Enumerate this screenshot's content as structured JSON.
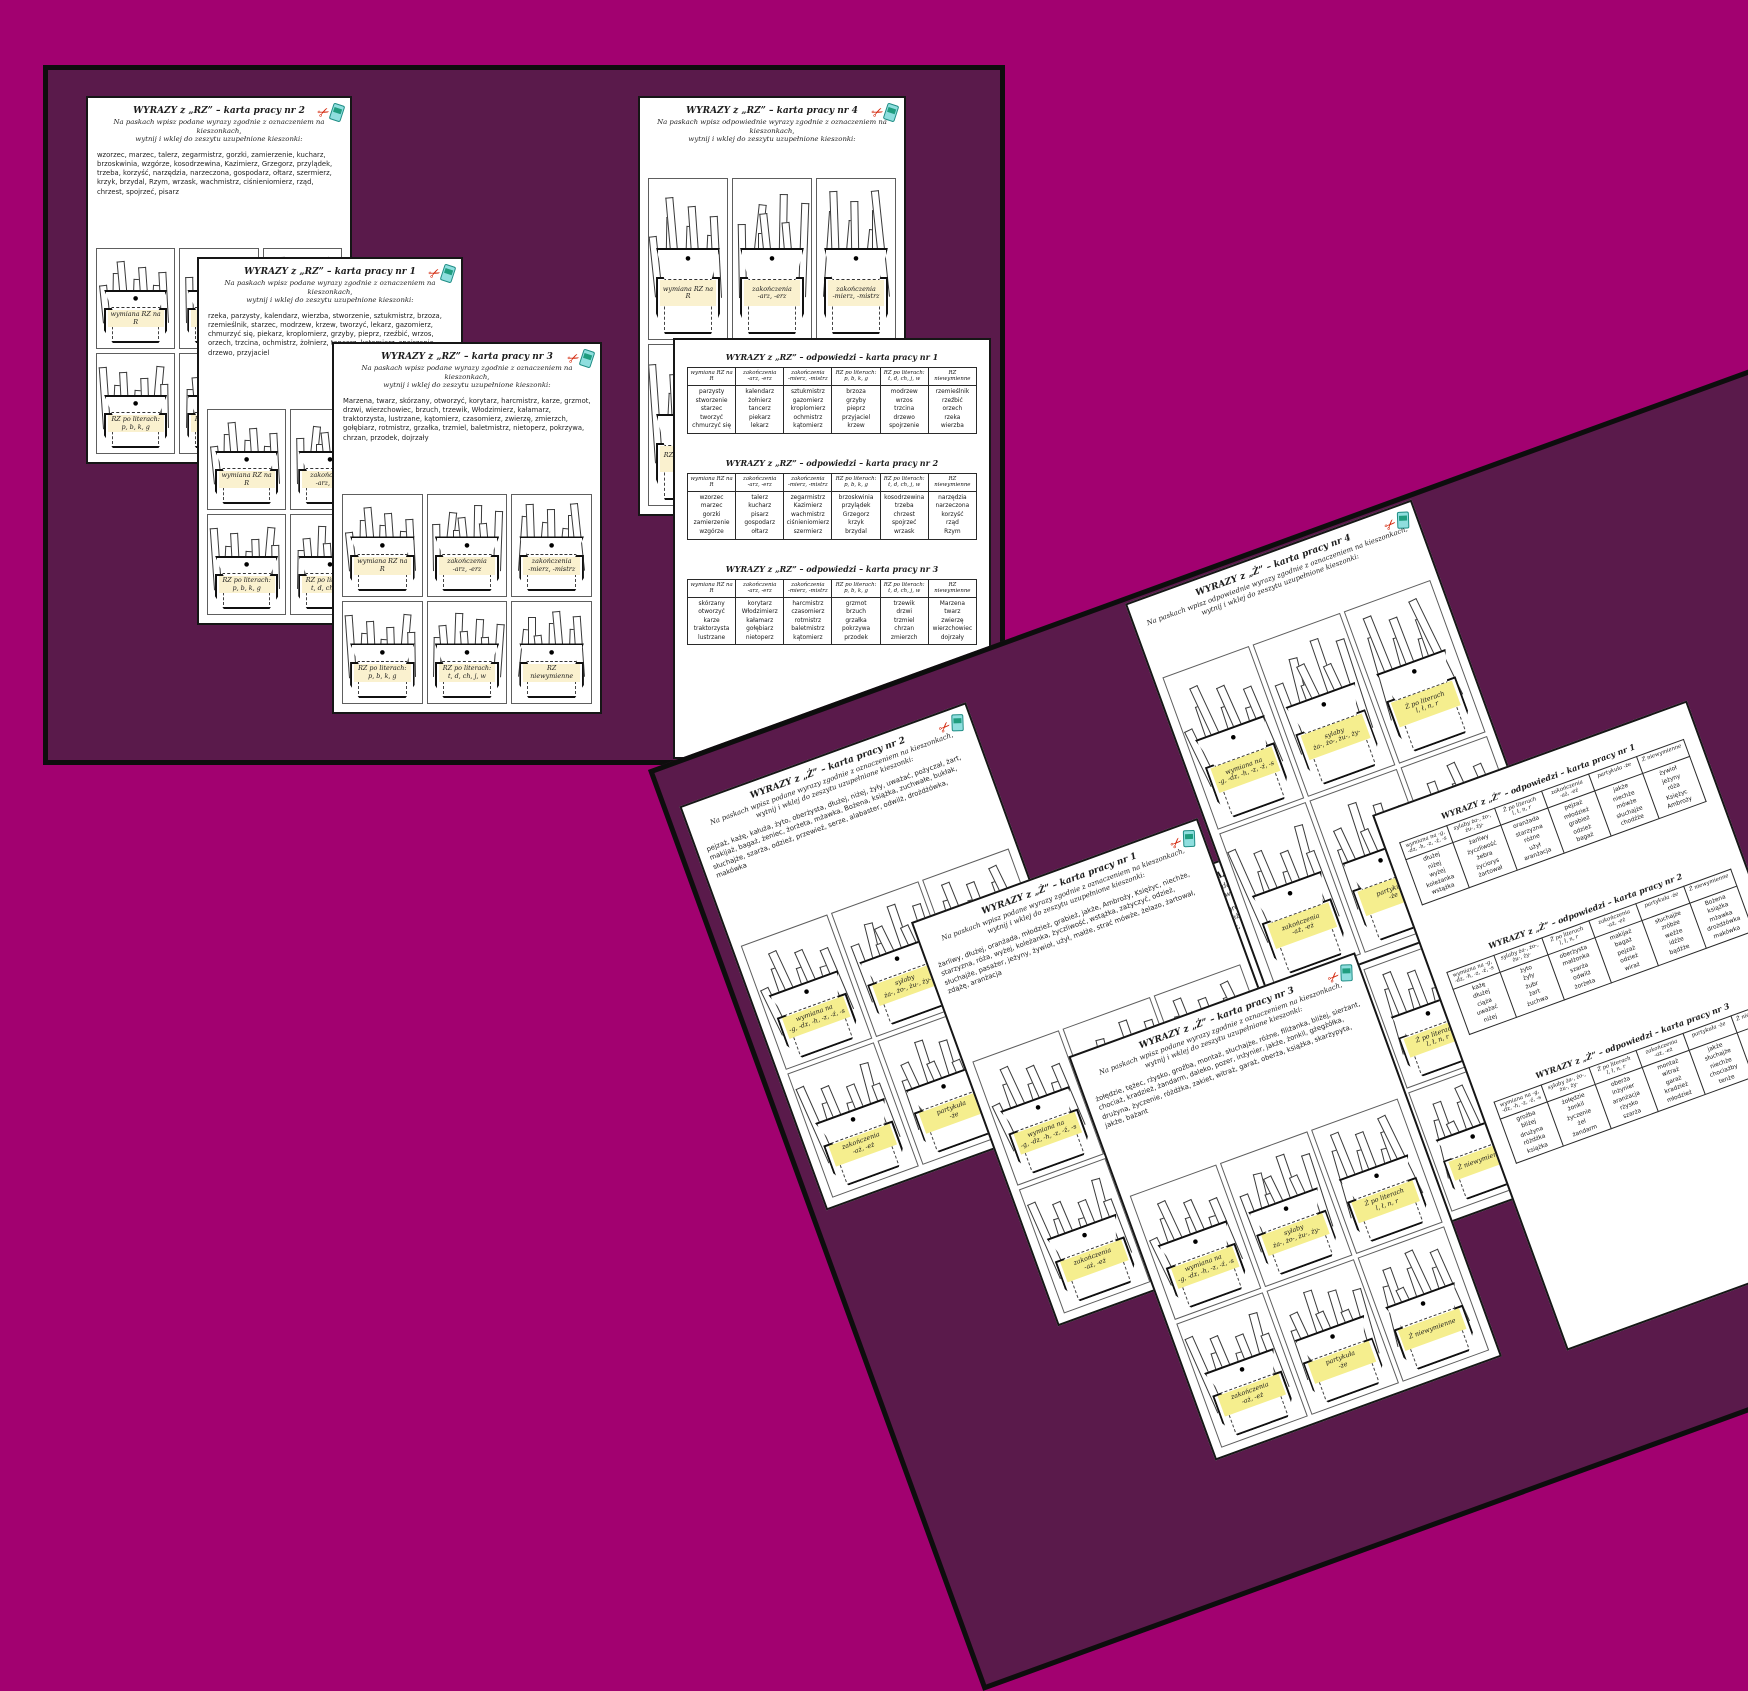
{
  "colors": {
    "page_bg": "#a20170",
    "board_bg": "#5a1a4b",
    "label_cream": "#faf1cf",
    "label_yellow": "#f5ee8e",
    "scissors_red": "#d42a0f",
    "glue_teal": "#8fdede"
  },
  "icons": {
    "scissors": "scissors-icon",
    "glue": "glue-bottle-icon"
  },
  "rz_pockets": [
    "wymiana RZ na R",
    "zakończenia\n-arz, -erz",
    "zakończenia\n-mierz, -mistrz",
    "RZ po literach:\np, b, k, g",
    "RZ po literach:\nt, d, ch, j, w",
    "RZ niewymienne"
  ],
  "z_pockets": [
    "wymiana na\n-g, -dz, -h, -z, -ź, -s",
    "sylaby\nża-, żo-, żu-, ży-",
    "Ż po literach\nl, ł, n, r",
    "zakończenia\n-aż, -eż",
    "partykuła\n-że",
    "Ż niewymienne"
  ],
  "boards": {
    "straight": {
      "sheets": {
        "rz2": {
          "title": "WYRAZY z „RZ” – karta pracy nr 2",
          "instructions": "Na paskach wpisz podane wyrazy zgodnie z oznaczeniem na kieszonkach,\nwytnij i wklej do zeszytu uzupełnione kieszonki:",
          "words": "wzorzec, marzec, talerz, zegarmistrz, gorzki, zamierzenie, kucharz, brzoskwinia, wzgórze, kosodrzewina, Kazimierz, Grzegorz, przylądek, trzeba, korzyść, narzędzia, narzeczona, gospodarz, ołtarz, szermierz, krzyk, brzydal, Rzym, wrzask, wachmistrz, ciśnieniomierz, rząd, chrzest, spojrzeć, pisarz",
          "pockets": [
            "wymiana RZ na R",
            "zakończenia\n-arz, -erz",
            "zakończenia\n-mierz, -mistrz",
            "RZ po literach:\np, b, k, g",
            "RZ po literach:\nt, d, ch, j, w",
            "RZ niewymienne"
          ]
        },
        "rz1": {
          "title": "WYRAZY z „RZ” – karta pracy nr 1",
          "instructions": "Na paskach wpisz podane wyrazy zgodnie z oznaczeniem na kieszonkach,\nwytnij i wklej do zeszytu uzupełnione kieszonki:",
          "words": "rzeka, parzysty, kalendarz, wierzba, stworzenie, sztukmistrz, brzoza, rzemieślnik, starzec, modrzew, krzew, tworzyć, lekarz, gazomierz, chmurzyć się, piekarz, kroplomierz, grzyby, pieprz, rzeźbić, wrzos, orzech, trzcina, ochmistrz, żołnierz, tancerz, kątomierz, spojrzenie, drzewo, przyjaciel",
          "pockets": [
            "wymiana RZ na R",
            "zakończenia\n-arz, -erz",
            "zakończenia\n-mierz, -mistrz",
            "RZ po literach:\np, b, k, g",
            "RZ po literach:\nt, d, ch, j, w",
            "RZ niewymienne"
          ]
        },
        "rz3": {
          "title": "WYRAZY z „RZ” – karta pracy nr 3",
          "instructions": "Na paskach wpisz podane wyrazy zgodnie z oznaczeniem na kieszonkach,\nwytnij i wklej do zeszytu uzupełnione kieszonki:",
          "words": "Marzena, twarz, skórzany, otworzyć, korytarz, harcmistrz, karze, grzmot, drzwi, wierzchowiec, brzuch, trzewik, Włodzimierz, kałamarz, traktorzysta, lustrzane, kątomierz, czasomierz, zwierzę, zmierzch, gołębiarz, rotmistrz, grzałka, trzmiel, baletmistrz, nietoperz, pokrzywa, chrzan, przodek, dojrzały",
          "pockets": [
            "wymiana RZ na R",
            "zakończenia\n-arz, -erz",
            "zakończenia\n-mierz, -mistrz",
            "RZ po literach:\np, b, k, g",
            "RZ po literach:\nt, d, ch, j, w",
            "RZ niewymienne"
          ]
        },
        "rz4": {
          "title": "WYRAZY z „RZ” – karta pracy nr 4",
          "instructions": "Na paskach wpisz odpowiednie wyrazy zgodnie z oznaczeniem na kieszonkach,\nwytnij i wklej do zeszytu uzupełnione kieszonki:",
          "words": "",
          "pockets": [
            "wymiana RZ na R",
            "zakończenia\n-arz, -erz",
            "zakończenia\n-mierz, -mistrz",
            "RZ po literach:\np, b, k, g",
            "RZ po literach:\nt, d, ch, j, w",
            "RZ niewymienne"
          ]
        },
        "rz_answers": {
          "tables": [
            {
              "title": "WYRAZY z „RZ”  – odpowiedzi – karta pracy nr 1",
              "headers": [
                "wymiana RZ na R",
                "zakończenia\n-arz, -erz",
                "zakończenia\n-mierz, -mistrz",
                "RZ po literach:\np, b, k, g",
                "RZ po literach:\nt, d, ch, j, w",
                "RZ niewymienne"
              ],
              "columns": [
                [
                  "parzysty",
                  "stworzenie",
                  "starzec",
                  "tworzyć",
                  "chmurzyć się"
                ],
                [
                  "kalendarz",
                  "żołnierz",
                  "tancerz",
                  "piekarz",
                  "lekarz"
                ],
                [
                  "sztukmistrz",
                  "gazomierz",
                  "kroplomierz",
                  "ochmistrz",
                  "kątomierz"
                ],
                [
                  "brzoza",
                  "grzyby",
                  "pieprz",
                  "przyjaciel",
                  "krzew"
                ],
                [
                  "modrzew",
                  "wrzos",
                  "trzcina",
                  "drzewo",
                  "spojrzenie"
                ],
                [
                  "rzemieślnik",
                  "rzeźbić",
                  "orzech",
                  "rzeka",
                  "wierzba"
                ]
              ]
            },
            {
              "title": "WYRAZY z „RZ”  – odpowiedzi – karta pracy nr 2",
              "headers": [
                "wymiana RZ na R",
                "zakończenia\n-arz, -erz",
                "zakończenia\n-mierz, -mistrz",
                "RZ po literach:\np, b, k, g",
                "RZ po literach:\nt, d, ch, j, w",
                "RZ niewymienne"
              ],
              "columns": [
                [
                  "wzorzec",
                  "marzec",
                  "gorzki",
                  "zamierzenie",
                  "wzgórze"
                ],
                [
                  "talerz",
                  "kucharz",
                  "pisarz",
                  "gospodarz",
                  "ołtarz"
                ],
                [
                  "zegarmistrz",
                  "Kazimierz",
                  "wachmistrz",
                  "ciśnieniomierz",
                  "szermierz"
                ],
                [
                  "brzoskwinia",
                  "przylądek",
                  "Grzegorz",
                  "krzyk",
                  "brzydal"
                ],
                [
                  "kosodrzewina",
                  "trzeba",
                  "chrzest",
                  "spojrzeć",
                  "wrzask"
                ],
                [
                  "narzędzia",
                  "narzeczona",
                  "korzyść",
                  "rząd",
                  "Rzym"
                ]
              ]
            },
            {
              "title": "WYRAZY z „RZ”  – odpowiedzi – karta pracy nr 3",
              "headers": [
                "wymiana RZ na R",
                "zakończenia\n-arz, -erz",
                "zakończenia\n-mierz, -mistrz",
                "RZ po literach:\np, b, k, g",
                "RZ po literach:\nt, d, ch, j, w",
                "RZ niewymienne"
              ],
              "columns": [
                [
                  "skórzany",
                  "otworzyć",
                  "karze",
                  "traktorzysta",
                  "lustrzane"
                ],
                [
                  "korytarz",
                  "Włodzimierz",
                  "kałamarz",
                  "gołębiarz",
                  "nietoperz"
                ],
                [
                  "harcmistrz",
                  "czasomierz",
                  "rotmistrz",
                  "baletmistrz",
                  "kątomierz"
                ],
                [
                  "grzmot",
                  "brzuch",
                  "grzałka",
                  "pokrzywa",
                  "przodek"
                ],
                [
                  "trzewik",
                  "drzwi",
                  "trzmiel",
                  "chrzan",
                  "zmierzch"
                ],
                [
                  "Marzena",
                  "twarz",
                  "zwierzę",
                  "wierzchowiec",
                  "dojrzały"
                ]
              ]
            }
          ]
        }
      }
    },
    "rotated": {
      "sheets": {
        "z4": {
          "title": "WYRAZY z „Ż” – karta pracy nr 4",
          "instructions": "Na paskach wpisz odpowiednie wyrazy zgodnie z oznaczeniem na kieszonkach,\nwytnij i wklej do zeszytu uzupełnione kieszonki:",
          "words": "",
          "pockets": [
            "wymiana na\n-g, -dz, -h, -z, -ź, -s",
            "sylaby\nża-, żo-, żu-, ży-",
            "Ż po literach\nl, ł, n, r",
            "zakończenia\n-aż, -eż",
            "partykuła\n-że",
            "Ż niewymienne"
          ]
        },
        "z2": {
          "title": "WYRAZY z „Ż” – karta pracy nr 2",
          "instructions": "Na paskach wpisz podane wyrazy zgodnie z oznaczeniem na kieszonkach,\nwytnij i wklej do zeszytu uzupełnione kieszonki:",
          "words": "pejzaż, każę, kałuża, żyto, oberżysta, dłużej, niżej, żyły, uważać, pożyczał, żart, makijaż, bagaż, żeniec, żorżeta, mżawka, Bożena, książka, zuchwałe, bukłak, słuchajże, szarża, odzież, przewieź, serze, alabaster, odwilż, drożdżówka, makówka",
          "pockets": [
            "wymiana na\n-g, -dz, -h, -z, -ź, -s",
            "sylaby\nża-, żo-, żu-, ży-",
            "Ż po literach\nl, ł, n, r",
            "zakończenia\n-aż, -eż",
            "partykuła\n-że",
            "Ż niewymienne"
          ]
        },
        "z1": {
          "title": "WYRAZY z „Ż” – karta pracy nr 1",
          "instructions": "Na paskach wpisz podane wyrazy zgodnie z oznaczeniem na kieszonkach,\nwytnij i wklej do zeszytu uzupełnione kieszonki:",
          "words": "żarliwy, dłużej, oranżada, młodzież, grabież, jakże, Ambroży, Księżyc, niechże, starzyzna, róża, wyżej, koleżanka, życzliwość, wstążka, zażyczyć, odzież, słuchajże, pasażer, jeżyny, żywioł, użył, małże, strać mówże, żelazo, żartował, zdążę, aranżacja",
          "pockets": [
            "wymiana na\n-g, -dz, -h, -z, -ź, -s",
            "sylaby\nża-, żo-, żu-, ży-",
            "Ż po literach\nl, ł, n, r",
            "zakończenia\n-aż, -eż",
            "partykuła\n-że",
            "Ż niewymienne"
          ]
        },
        "z3": {
          "title": "WYRAZY z „Ż” – karta pracy nr 3",
          "instructions": "Na paskach wpisz podane wyrazy zgodnie z oznaczeniem na kieszonkach,\nwytnij i wklej do zeszytu uzupełnione kieszonki:",
          "words": "żołędzie, tężec, rżysko, groźba, montaż, słuchajże, różne, filiżanka, bliżej, sierżant, chociaż, kradzież, żandarm, daleko, pozer, inżynier, jakże, żonkil, gżegżółka, drużyna, życzenie, różdżka, zakiet, witraż, garaż, oberża, książka, skarżypyta, jakże, bażant",
          "pockets": [
            "wymiana na\n-g, -dz, -h, -z, -ź, -s",
            "sylaby\nża-, żo-, żu-, ży-",
            "Ż po literach\nl, ł, n, r",
            "zakończenia\n-aż, -eż",
            "partykuła\n-że",
            "Ż niewymienne"
          ]
        },
        "z_partial": {
          "title": "WYRAZY z „Ż” – karta pracy nr 3",
          "instructions": "Na paskach wpisz podane wyrazy zgodnie z oznaczeniem na kieszonkach,\nwytnij i wklej do zeszytu uzupełnione kieszonki:",
          "words": "żołędzie, tężec, rżysko, groźba, montaż, słuchajże, różne, filiżanka, bliżej, sierżant, chociaż, kradzież, żandarm, inżynier, jakże, żonkil, gżegżółka, drużyna, życzenie, różdżka, witraż, garaż, oberża, książka, skarżypyta, bażant",
          "pockets": [
            "wymiana na\n-g, -dz, -h, -z, -ź, -s",
            "sylaby\nża-, żo-, żu-, ży-",
            "Ż po literach\nl, ł, n, r",
            "zakończenia\n-aż, -eż",
            "partykuła\n-że",
            "Ż niewymienne"
          ]
        },
        "z_answers": {
          "tables": [
            {
              "title": "WYRAZY z „Ż”  – odpowiedzi – karta pracy nr 1",
              "headers": [
                "wymiana na -g,\n-dz, -h, -z, -ź, -s",
                "sylaby ża-, żo-,\nżu-, ży-",
                "Ż po literach\nl, ł, n, r",
                "zakończenia\n-aż, -eż",
                "partykuła -że",
                "Ż niewymienne"
              ],
              "columns": [
                [
                  "dłużej",
                  "niżej",
                  "wyżej",
                  "koleżanka",
                  "wstążka"
                ],
                [
                  "żarliwy",
                  "życzliwość",
                  "żebra",
                  "życiorys",
                  "żartował"
                ],
                [
                  "oranżada",
                  "starzyzna",
                  "różne",
                  "użył",
                  "aranżacja"
                ],
                [
                  "pejzaż",
                  "młodzież",
                  "grabież",
                  "odzież",
                  "bagaż"
                ],
                [
                  "jakże",
                  "niechże",
                  "mówże",
                  "słuchajże",
                  "chodźże"
                ],
                [
                  "żywioł",
                  "jeżyny",
                  "róża",
                  "Księżyc",
                  "Ambroży"
                ]
              ]
            },
            {
              "title": "WYRAZY z „Ż”  – odpowiedzi – karta pracy nr 2",
              "headers": [
                "wymiana na -g,\n-dz, -h, -z, -ź, -s",
                "sylaby ża-, żo-,\nżu-, ży-",
                "Ż po literach\nl, ł, n, r",
                "zakończenia\n-aż, -eż",
                "partykuła -że",
                "Ż niewymienne"
              ],
              "columns": [
                [
                  "każę",
                  "dłużej",
                  "ciąża",
                  "uważać",
                  "niżej"
                ],
                [
                  "żyto",
                  "żyły",
                  "żubr",
                  "żart",
                  "żuchwa"
                ],
                [
                  "oberżysta",
                  "małżonka",
                  "szarża",
                  "odwilż",
                  "żorżeta"
                ],
                [
                  "makijaż",
                  "bagaż",
                  "pejzaż",
                  "odzież",
                  "wiraż"
                ],
                [
                  "słuchajże",
                  "zróbże",
                  "weźże",
                  "idźże",
                  "bądźże"
                ],
                [
                  "Bożena",
                  "książka",
                  "mżawka",
                  "drożdżówka",
                  "makówka"
                ]
              ]
            },
            {
              "title": "WYRAZY z „Ż”  – odpowiedzi – karta pracy nr 3",
              "headers": [
                "wymiana na -g,\n-dz, -h, -z, -ź, -s",
                "sylaby ża-, żo-,\nżu-, ży-",
                "Ż po literach\nl, ł, n, r",
                "zakończenia\n-aż, -eż",
                "partykuła -że",
                "Ż niewymienne"
              ],
              "columns": [
                [
                  "groźba",
                  "bliżej",
                  "drużyna",
                  "różdżka",
                  "książka"
                ],
                [
                  "żołędzie",
                  "żonkil",
                  "życzenie",
                  "żel",
                  "żandarm"
                ],
                [
                  "oberża",
                  "inżynier",
                  "aranżacja",
                  "rżysko",
                  "szarża"
                ],
                [
                  "montaż",
                  "witraż",
                  "garaż",
                  "kradzież",
                  "młodzież"
                ],
                [
                  "jakże",
                  "słuchajże",
                  "niechże",
                  "chociażby",
                  "tenże"
                ],
                [
                  "filiżanka",
                  "sierżant",
                  "bażant",
                  "gżegżółka",
                  "skarżypyta"
                ]
              ]
            }
          ]
        }
      }
    }
  }
}
